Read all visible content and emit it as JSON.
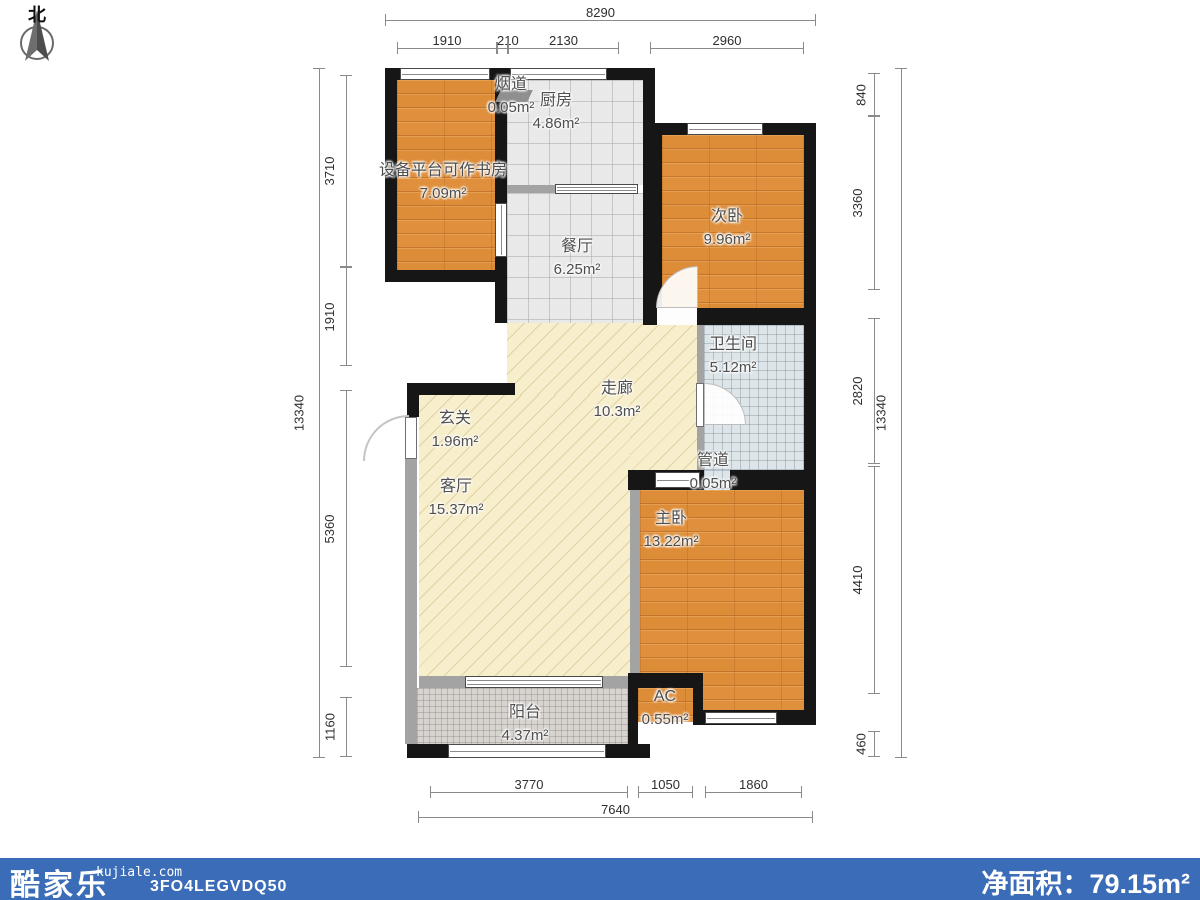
{
  "compass": {
    "north": "北"
  },
  "rooms": [
    {
      "id": "flue",
      "name": "烟道",
      "area": "0.05m²"
    },
    {
      "id": "kitchen",
      "name": "厨房",
      "area": "4.86m²"
    },
    {
      "id": "study",
      "name": "设备平台可作书房",
      "area": "7.09m²"
    },
    {
      "id": "dining",
      "name": "餐厅",
      "area": "6.25m²"
    },
    {
      "id": "bedroom2",
      "name": "次卧",
      "area": "9.96m²"
    },
    {
      "id": "bathroom",
      "name": "卫生间",
      "area": "5.12m²"
    },
    {
      "id": "corridor",
      "name": "走廊",
      "area": "10.3m²"
    },
    {
      "id": "entry",
      "name": "玄关",
      "area": "1.96m²"
    },
    {
      "id": "living",
      "name": "客厅",
      "area": "15.37m²"
    },
    {
      "id": "pipe",
      "name": "管道",
      "area": "0.05m²"
    },
    {
      "id": "master",
      "name": "主卧",
      "area": "13.22m²"
    },
    {
      "id": "ac",
      "name": "AC",
      "area": "0.55m²"
    },
    {
      "id": "balcony",
      "name": "阳台",
      "area": "4.37m²"
    }
  ],
  "dims": {
    "top": {
      "total": "8290",
      "segments": [
        "1910",
        "210",
        "2130",
        "2960"
      ]
    },
    "bottom": {
      "total": "7640",
      "segments": [
        "3770",
        "1050",
        "1860"
      ]
    },
    "left": {
      "total": "13340",
      "segments": [
        "3710",
        "1910",
        "5360",
        "1160"
      ]
    },
    "right": {
      "total": "13340",
      "segments": [
        "840",
        "3360",
        "2820",
        "4410",
        "460"
      ]
    }
  },
  "footer": {
    "brand": "酷家乐",
    "site": "kujiale.com",
    "code": "3FO4LEGVDQ50",
    "net_area_label": "净面积：",
    "net_area_value": "79.15m²"
  },
  "colors": {
    "wall": "#161616",
    "wood_floor": "#e0903c",
    "tile_floor": "#e9e9e9",
    "bath_floor": "#dee5e9",
    "hatch_floor": "#f7eecb",
    "balcony_floor": "#d7d3cf",
    "footer_blue": "#3a6cb8"
  }
}
